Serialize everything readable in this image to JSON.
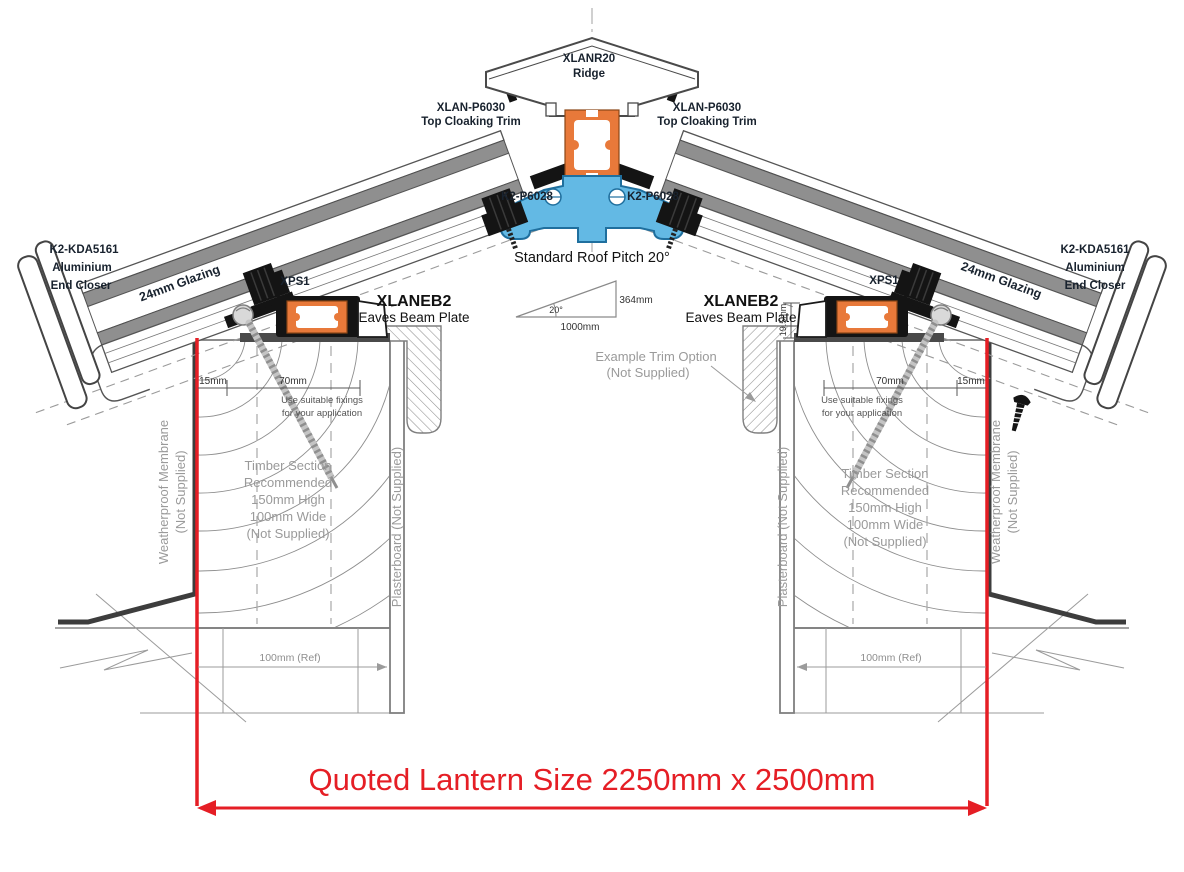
{
  "drawing": {
    "ridge": {
      "part": "XLANR20",
      "name": "Ridge"
    },
    "cloaking": {
      "part": "XLAN-P6030",
      "name": "Top Cloaking Trim"
    },
    "glazing_bar": {
      "part": "K2-P6028"
    },
    "pitch": {
      "title": "Standard Roof Pitch 20°",
      "angle": "20°",
      "rise": "364mm",
      "run": "1000mm"
    },
    "end_closer": {
      "part": "K2-KDA5161",
      "line1": "Aluminium",
      "line2": "End Closer"
    },
    "glazing": {
      "label": "24mm Glazing"
    },
    "spacer": {
      "part": "XPS1"
    },
    "eaves_beam": {
      "part": "XLANEB2",
      "name": "Eaves Beam Plate"
    },
    "trim_option": {
      "line1": "Example  Trim Option",
      "line2": "(Not Supplied)"
    },
    "dims": {
      "d15": "15mm",
      "d70": "70mm",
      "d19_5": "19.5mm",
      "ref100": "100mm (Ref)"
    },
    "fixings_note": {
      "line1": "Use suitable fixings",
      "line2": "for your application"
    },
    "timber_note": {
      "line1": "Timber Section",
      "line2": "Recommended",
      "line3": "150mm High",
      "line4": "100mm Wide",
      "line5": "(Not Supplied)"
    },
    "membrane_note": {
      "line1": "Weatherproof Membrane",
      "line2": "(Not Supplied)"
    },
    "plasterboard_note": {
      "label": "Plasterboard (Not Supplied)"
    },
    "quoted": {
      "label": "Quoted Lantern Size 2250mm x 2500mm"
    }
  },
  "colors": {
    "accent_red": "#e51e25",
    "accent_orange": "#e8793a",
    "blue_fill": "#63b9e4",
    "blue_stroke": "#1f6f9e",
    "part_label": "#18222e",
    "note_gray": "#9a9a9a",
    "line_gray": "#6e6e6e",
    "pane_gray": "#8f8f8f"
  }
}
